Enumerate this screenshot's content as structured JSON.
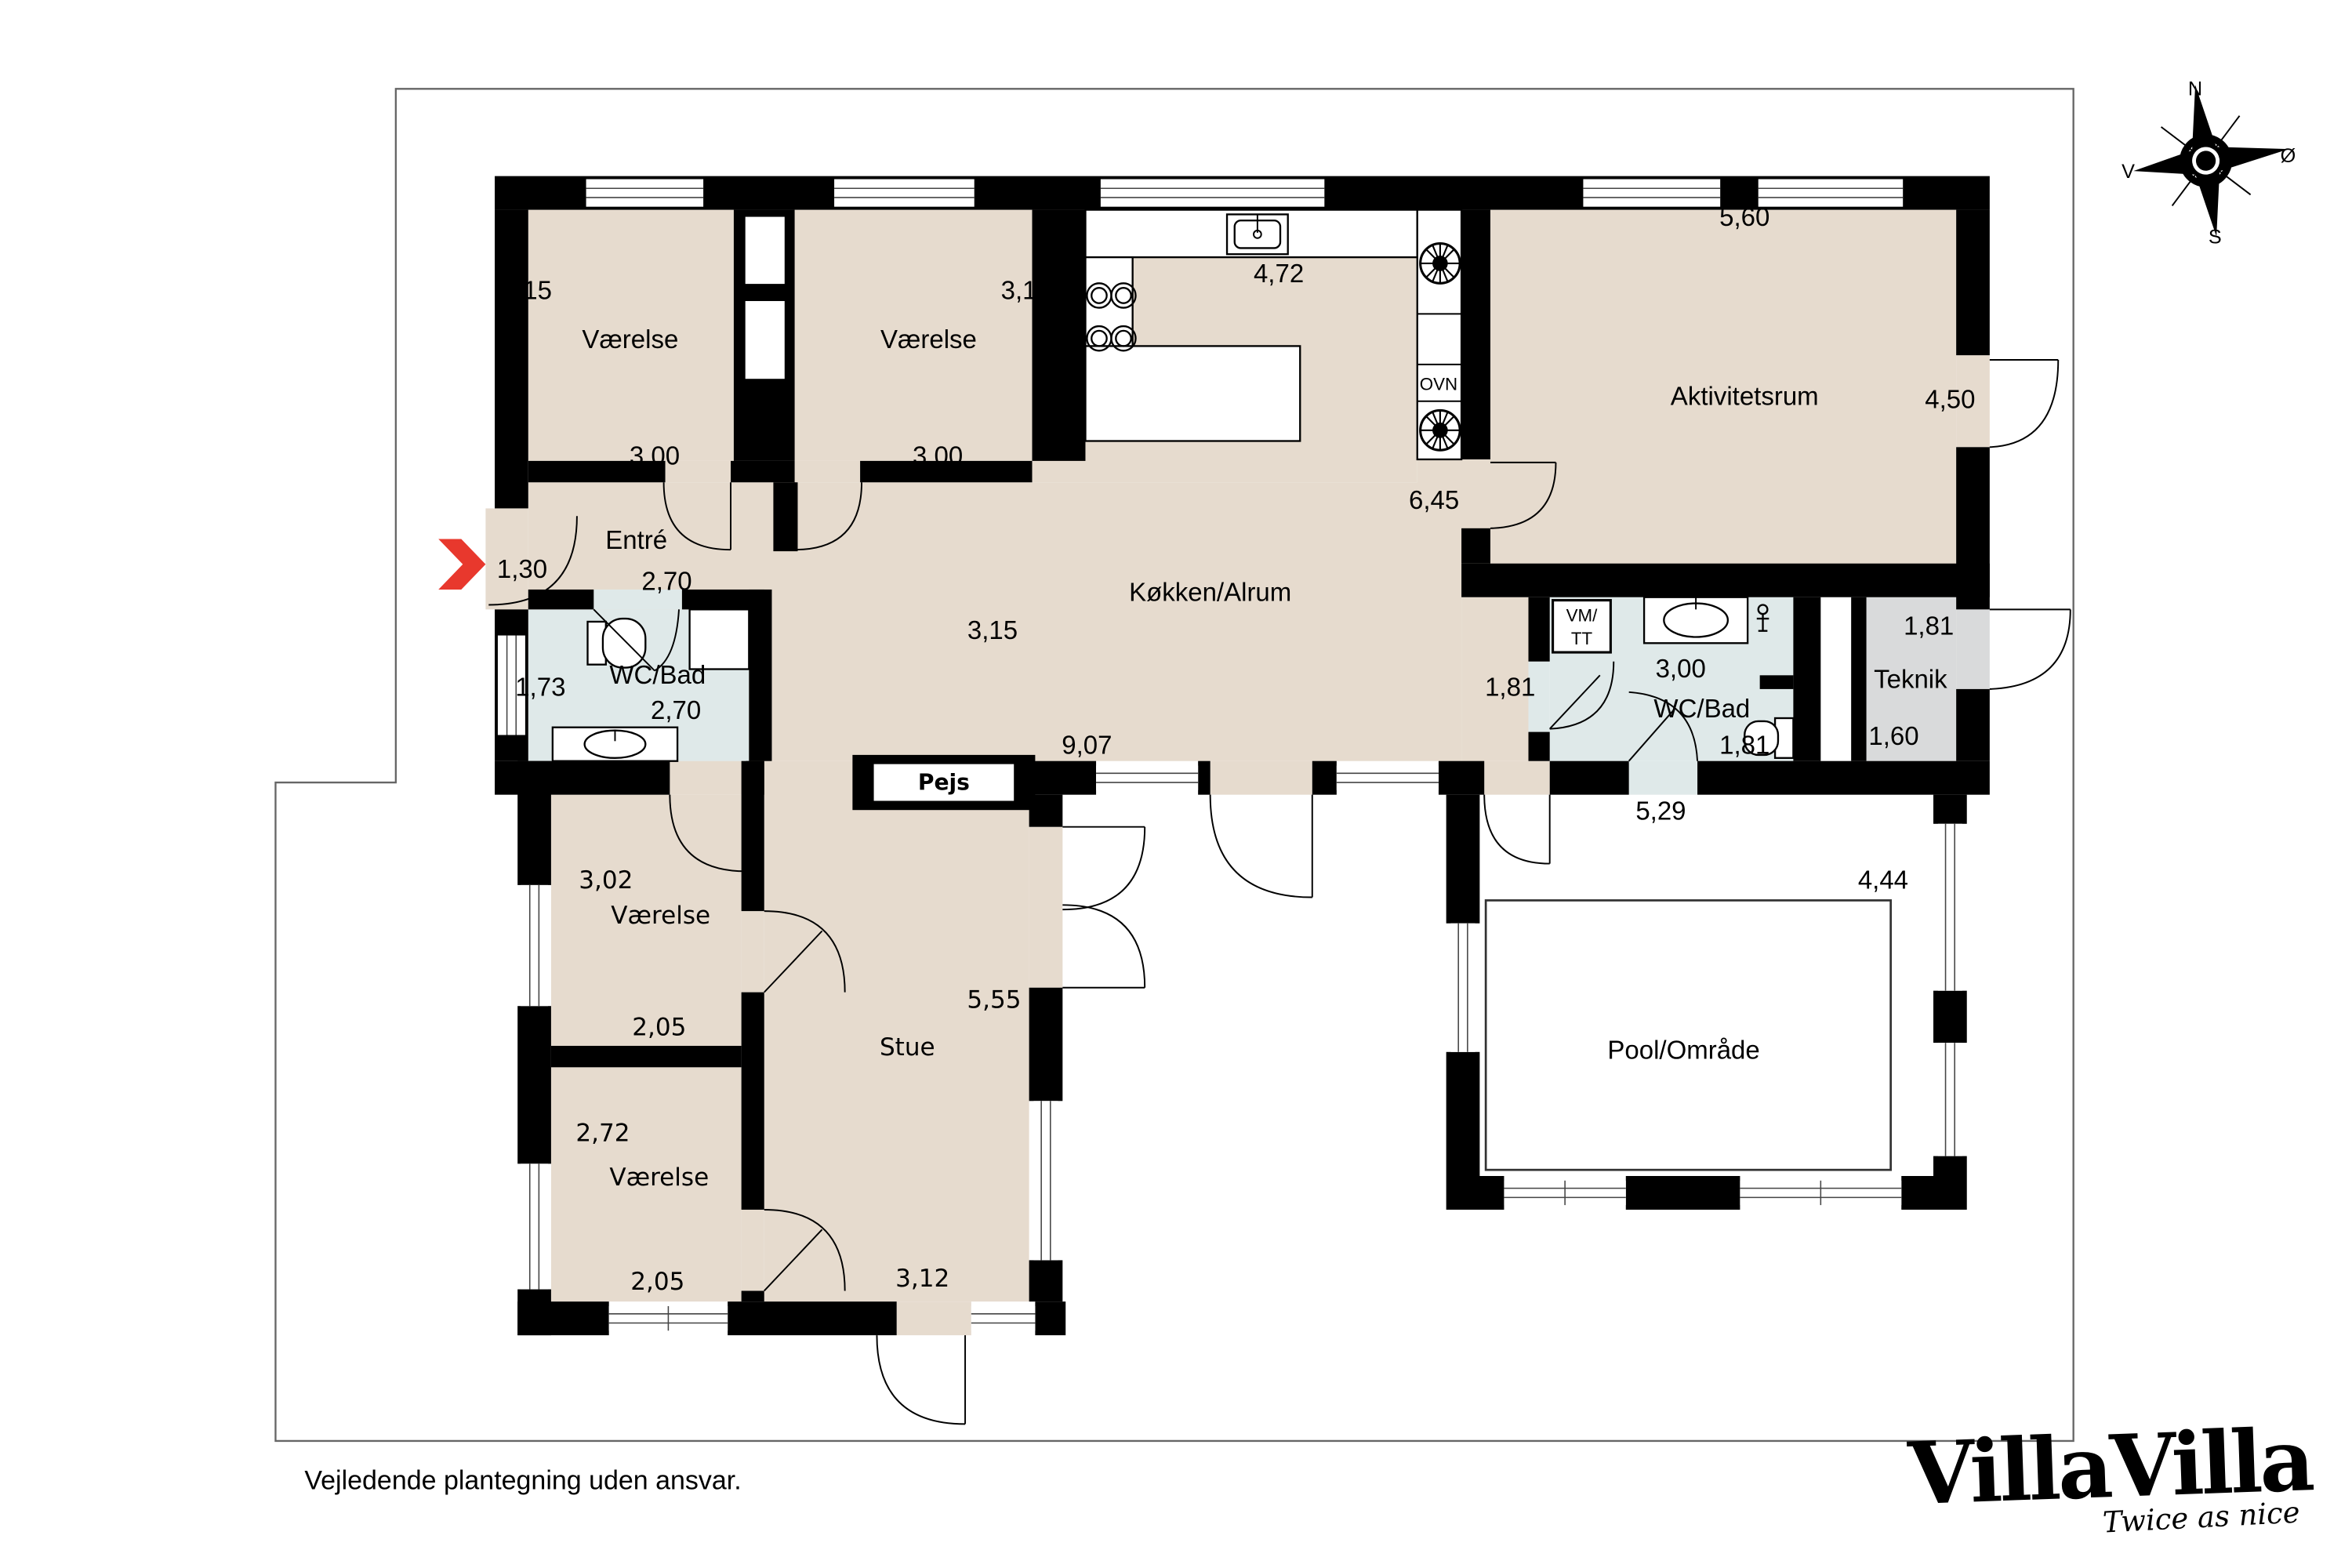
{
  "labels": {
    "room_nw_height": "3,15",
    "room_nw_name": "Værelse",
    "room_nw_width": "3,00",
    "room_n2_height": "3,15",
    "room_n2_name": "Værelse",
    "room_n2_width": "3,00",
    "kitchen_counter": "4,72",
    "activity_width": "5,60",
    "activity_name": "Aktivitetsrum",
    "activity_height": "4,50",
    "kitchen_height": "6,45",
    "entry_name": "Entré",
    "entry_recess": "1,30",
    "entry_width": "2,70",
    "kitchen_name": "Køkken/Alrum",
    "kitchen_mid": "3,15",
    "bath_left_height": "1,73",
    "bath_left_name": "WC/Bad",
    "bath_left_width": "2,70",
    "kitchen_right": "1,81",
    "bath_right_width": "3,00",
    "bath_right_name": "WC/Bad",
    "bath_right_height": "1,81",
    "tech_width": "1,81",
    "tech_name": "Teknik",
    "tech_height": "1,60",
    "kitchen_bottom": "9,07",
    "walkway_width": "5,29",
    "pool_width": "4,44",
    "pool_name": "Pool/Område",
    "living_height": "5,55",
    "living_name": "Stue",
    "living_width": "3,12",
    "room_w1_height": "3,02",
    "room_w1_name": "Værelse",
    "room_w1_width": "2,05",
    "room_w2_height": "2,72",
    "room_w2_name": "Værelse",
    "room_w2_width": "2,05",
    "fireplace": "Pejs",
    "oven": "OVN",
    "washer_line1": "VM/",
    "washer_line2": "TT"
  },
  "compass": {
    "north": "N",
    "south": "S",
    "east": "Ø",
    "west": "V"
  },
  "footer": {
    "disclaimer": "Vejledende plantegning uden ansvar."
  },
  "brand": {
    "logo": "VillaVilla",
    "tagline": "Twice as nice"
  },
  "colors": {
    "room_fill": "#e6dbce",
    "bath_fill": "#dfe9e9",
    "tech_fill": "#d9dadb",
    "wall": "#000000",
    "arrow": "#e8382d",
    "boundary": "#666666"
  }
}
